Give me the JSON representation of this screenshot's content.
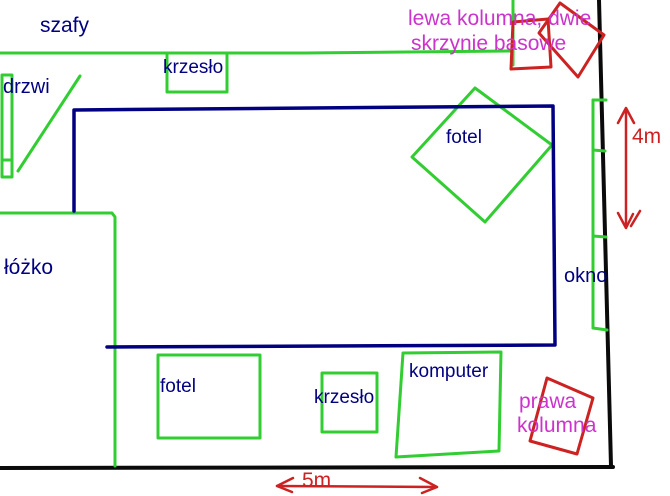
{
  "colors": {
    "background": "#ffffff",
    "wall": "#0a0a0a",
    "furniture_green": "#32cd32",
    "room_navy": "#000080",
    "label_navy": "#000080",
    "speaker_red": "#cc2222",
    "dimension_red": "#cc2222",
    "speaker_label_magenta": "#cc33cc"
  },
  "furniture": {
    "wardrobes": "szafy",
    "door": "drzwi",
    "chair_top": "krzesło",
    "armchair_top": "fotel",
    "bed": "łóżko",
    "window": "okno",
    "armchair_bottom": "fotel",
    "chair_bottom": "krzesło",
    "computer": "komputer"
  },
  "speakers": {
    "left_column_line1": "lewa kolumna, dwie",
    "left_column_line2": "skrzynie basowe",
    "right_column_line1": "prawa",
    "right_column_line2": "kolumna"
  },
  "dimensions": {
    "room_height": "4m",
    "room_width": "5m"
  }
}
